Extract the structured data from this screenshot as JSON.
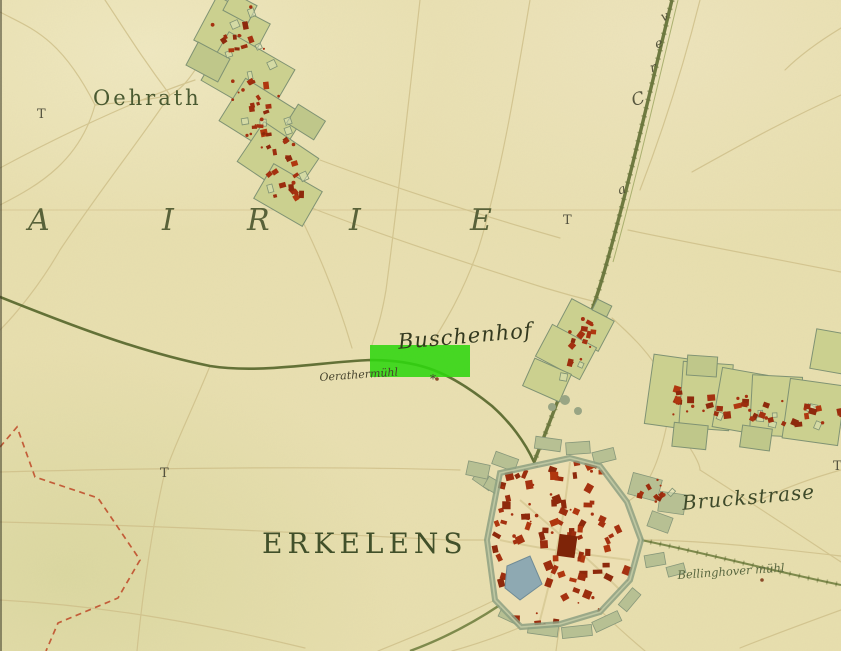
{
  "map": {
    "labels": {
      "oehrath": "Oehrath",
      "district_letters": [
        "A",
        "I",
        "R",
        "I",
        "E"
      ],
      "buschenhof": "Buschenhof",
      "oerather_muehl": "Oerathermühl",
      "oerather_mark": "*",
      "erkelens": "ERKELENS",
      "bruckstrase": "Bruckstrase",
      "bellinghover": "Bellinghover mühl",
      "road_letters": [
        "a",
        "C",
        "r",
        "e",
        "v"
      ],
      "t_markers": [
        "T",
        "T",
        "T",
        "T"
      ]
    },
    "highlight": {
      "fill": "#2fd60f",
      "opacity": "0.88"
    },
    "palette": {
      "parchment": "#e8dfae",
      "village_green": "#c9ce8e",
      "building_red": "#a53110",
      "road_olive": "#5f6c31",
      "boundary_red": "#bf4f2e",
      "label_green": "#46532d",
      "water_blue": "#8ea9b2",
      "wall_green": "#8da081"
    }
  }
}
